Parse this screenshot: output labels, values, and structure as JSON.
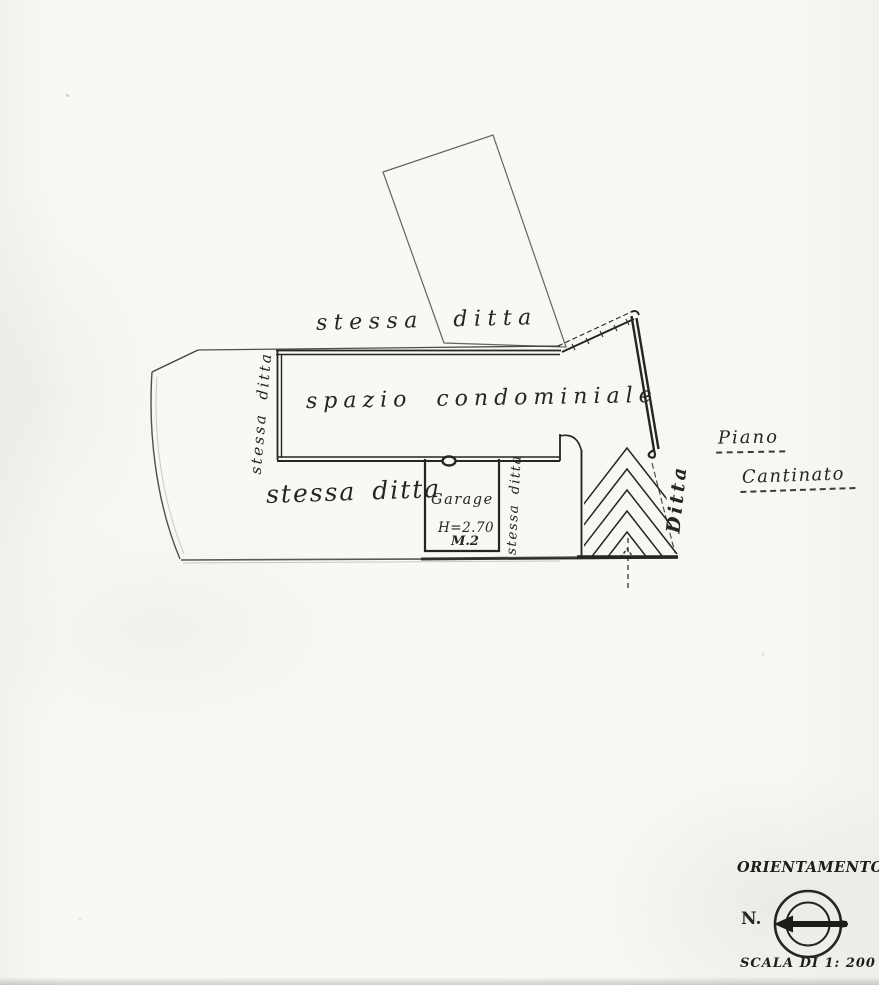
{
  "colors": {
    "paper": "#f6f6f3",
    "ink": "#26261f"
  },
  "plan": {
    "labels": {
      "top_boundary": "stessa ditta",
      "left_boundary": "stessa ditta",
      "lower_left": "stessa ditta",
      "main_area": "spazio condominiale",
      "garage_title": "Garage",
      "garage_height": "H=2.70",
      "garage_number": "M.2",
      "inner_vertical": "stessa ditta",
      "right_vertical": "Ditta",
      "floor_word1": "Piano",
      "floor_word2": "Cantinato"
    },
    "symbols": {
      "ramp": "hatched-ramp-chevrons",
      "north_arrow": "compass-north-arrow"
    }
  },
  "legend": {
    "orientation_title": "ORIENTAMENTO",
    "north_label": "N.",
    "scale_label": "SCALA DI 1: 200"
  }
}
